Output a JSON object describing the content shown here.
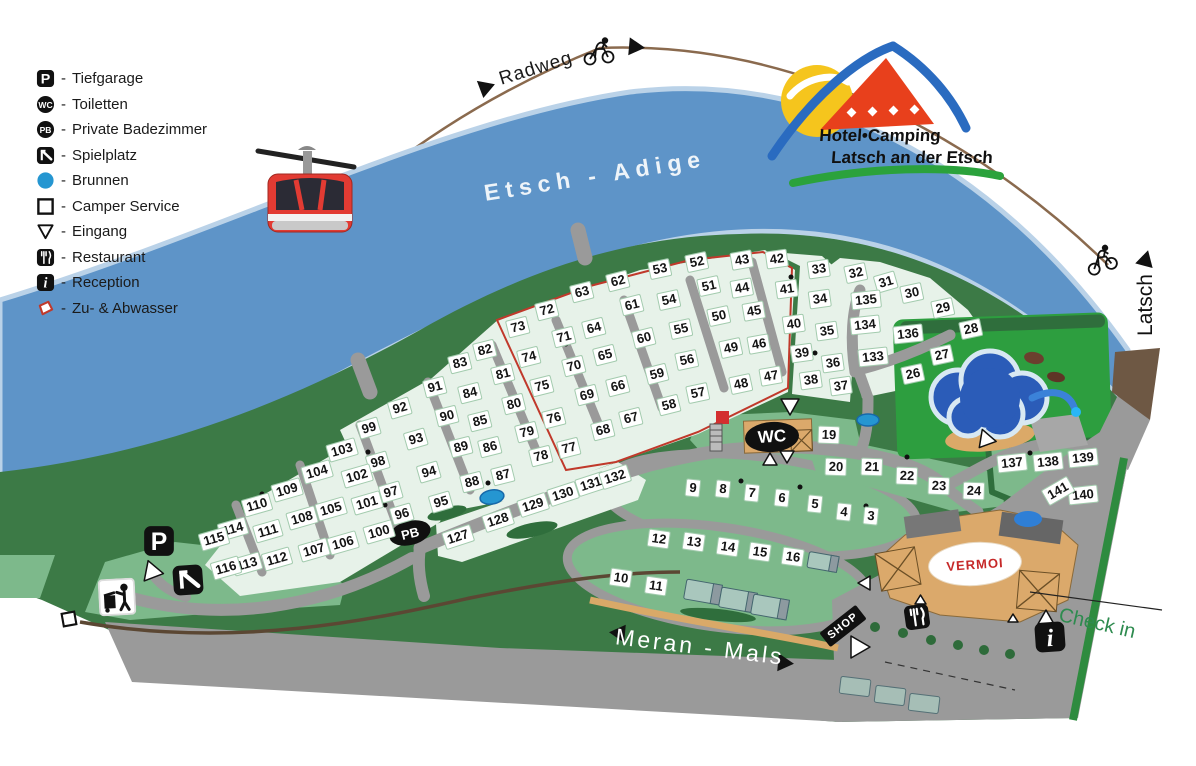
{
  "legend": {
    "sep": "-",
    "items": [
      {
        "icon": "tiefgarage",
        "label": "Tiefgarage"
      },
      {
        "icon": "toiletten",
        "label": "Toiletten"
      },
      {
        "icon": "private-badezimmer",
        "label": "Private Badezimmer"
      },
      {
        "icon": "spielplatz",
        "label": "Spielplatz"
      },
      {
        "icon": "brunnen",
        "label": "Brunnen"
      },
      {
        "icon": "camper-service",
        "label": "Camper Service"
      },
      {
        "icon": "eingang",
        "label": "Eingang"
      },
      {
        "icon": "restaurant",
        "label": "Restaurant"
      },
      {
        "icon": "reception",
        "label": "Reception"
      },
      {
        "icon": "zu-abwasser",
        "label": "Zu- & Abwasser"
      }
    ]
  },
  "logo": {
    "line1": "Hotel•Camping",
    "line2": "Latsch an der Etsch"
  },
  "labels": {
    "river": "Etsch - Adige",
    "bike_path": "Radweg",
    "road": "Meran - Mals",
    "town": "Latsch",
    "check_in": "Check in",
    "shop": "SHOP",
    "wc": "WC",
    "pb": "PB",
    "vermoi": "VERMOI"
  },
  "map": {
    "pitches": [
      [
        3,
        871,
        516,
        6
      ],
      [
        4,
        844,
        512,
        6
      ],
      [
        5,
        815,
        504,
        6
      ],
      [
        6,
        782,
        498,
        6
      ],
      [
        7,
        752,
        493,
        6
      ],
      [
        8,
        723,
        489,
        6
      ],
      [
        9,
        693,
        488,
        6
      ],
      [
        10,
        621,
        578,
        8
      ],
      [
        11,
        656,
        586,
        8
      ],
      [
        12,
        659,
        539,
        8
      ],
      [
        13,
        694,
        542,
        8
      ],
      [
        14,
        728,
        547,
        8
      ],
      [
        15,
        760,
        552,
        8
      ],
      [
        16,
        793,
        557,
        8
      ],
      [
        19,
        829,
        435,
        2
      ],
      [
        20,
        836,
        467,
        2
      ],
      [
        21,
        872,
        467,
        2
      ],
      [
        22,
        907,
        476,
        2
      ],
      [
        23,
        939,
        486,
        2
      ],
      [
        24,
        974,
        491,
        2
      ],
      [
        26,
        913,
        374,
        -12
      ],
      [
        27,
        942,
        355,
        -12
      ],
      [
        28,
        971,
        329,
        -12
      ],
      [
        29,
        943,
        308,
        -12
      ],
      [
        30,
        912,
        293,
        -12
      ],
      [
        31,
        886,
        282,
        -16
      ],
      [
        32,
        856,
        273,
        -12
      ],
      [
        33,
        819,
        269,
        -8
      ],
      [
        34,
        820,
        299,
        -8
      ],
      [
        35,
        827,
        331,
        -8
      ],
      [
        36,
        833,
        363,
        -8
      ],
      [
        37,
        841,
        386,
        -8
      ],
      [
        38,
        811,
        380,
        -8
      ],
      [
        39,
        802,
        353,
        -8
      ],
      [
        40,
        794,
        324,
        -8
      ],
      [
        41,
        787,
        289,
        -8
      ],
      [
        42,
        777,
        259,
        -8
      ],
      [
        43,
        742,
        260,
        -10
      ],
      [
        44,
        742,
        288,
        -10
      ],
      [
        45,
        754,
        311,
        -10
      ],
      [
        46,
        759,
        344,
        -10
      ],
      [
        47,
        771,
        376,
        -10
      ],
      [
        48,
        741,
        384,
        -12
      ],
      [
        49,
        731,
        348,
        -12
      ],
      [
        50,
        719,
        316,
        -12
      ],
      [
        51,
        709,
        286,
        -12
      ],
      [
        52,
        697,
        262,
        -12
      ],
      [
        53,
        660,
        269,
        -12
      ],
      [
        54,
        669,
        300,
        -12
      ],
      [
        55,
        681,
        329,
        -12
      ],
      [
        56,
        687,
        360,
        -12
      ],
      [
        57,
        698,
        393,
        -12
      ],
      [
        58,
        669,
        405,
        -14
      ],
      [
        59,
        657,
        374,
        -14
      ],
      [
        60,
        644,
        338,
        -14
      ],
      [
        61,
        632,
        305,
        -14
      ],
      [
        62,
        618,
        281,
        -14
      ],
      [
        63,
        582,
        292,
        -14
      ],
      [
        64,
        594,
        328,
        -14
      ],
      [
        65,
        605,
        355,
        -14
      ],
      [
        66,
        618,
        386,
        -14
      ],
      [
        67,
        631,
        418,
        -14
      ],
      [
        68,
        603,
        430,
        -14
      ],
      [
        69,
        587,
        395,
        -14
      ],
      [
        70,
        574,
        366,
        -14
      ],
      [
        71,
        564,
        337,
        -14
      ],
      [
        72,
        547,
        310,
        -14
      ],
      [
        73,
        518,
        327,
        -14
      ],
      [
        74,
        529,
        357,
        -14
      ],
      [
        75,
        542,
        386,
        -14
      ],
      [
        76,
        554,
        418,
        -14
      ],
      [
        77,
        569,
        448,
        -14
      ],
      [
        78,
        541,
        456,
        -14
      ],
      [
        79,
        527,
        432,
        -14
      ],
      [
        80,
        514,
        404,
        -14
      ],
      [
        81,
        503,
        374,
        -14
      ],
      [
        82,
        485,
        350,
        -14
      ],
      [
        83,
        460,
        363,
        -14
      ],
      [
        84,
        470,
        393,
        -14
      ],
      [
        85,
        480,
        421,
        -14
      ],
      [
        86,
        490,
        447,
        -14
      ],
      [
        87,
        503,
        475,
        -14
      ],
      [
        88,
        472,
        482,
        -14
      ],
      [
        89,
        461,
        447,
        -14
      ],
      [
        90,
        447,
        416,
        -14
      ],
      [
        91,
        435,
        387,
        -14
      ],
      [
        92,
        400,
        408,
        -16
      ],
      [
        93,
        416,
        439,
        -16
      ],
      [
        94,
        429,
        472,
        -16
      ],
      [
        95,
        441,
        502,
        -16
      ],
      [
        96,
        402,
        514,
        -16
      ],
      [
        97,
        391,
        492,
        -16
      ],
      [
        98,
        378,
        462,
        -16
      ],
      [
        99,
        369,
        428,
        -16
      ],
      [
        100,
        379,
        532,
        -16
      ],
      [
        101,
        367,
        503,
        -16
      ],
      [
        102,
        357,
        476,
        -16
      ],
      [
        103,
        342,
        450,
        -16
      ],
      [
        104,
        317,
        472,
        -16
      ],
      [
        105,
        331,
        509,
        -16
      ],
      [
        106,
        343,
        543,
        -16
      ],
      [
        107,
        314,
        550,
        -16
      ],
      [
        108,
        302,
        518,
        -16
      ],
      [
        109,
        287,
        490,
        -16
      ],
      [
        110,
        257,
        505,
        -16
      ],
      [
        111,
        268,
        531,
        -16
      ],
      [
        112,
        277,
        559,
        -16
      ],
      [
        113,
        247,
        564,
        -16
      ],
      [
        114,
        233,
        529,
        -16
      ],
      [
        115,
        214,
        539,
        -16
      ],
      [
        116,
        226,
        568,
        -16
      ],
      [
        127,
        458,
        537,
        -18
      ],
      [
        128,
        498,
        520,
        -18
      ],
      [
        129,
        533,
        505,
        -18
      ],
      [
        130,
        563,
        494,
        -18
      ],
      [
        131,
        591,
        484,
        -18
      ],
      [
        132,
        615,
        477,
        -18
      ],
      [
        133,
        873,
        357,
        -6
      ],
      [
        134,
        865,
        325,
        -6
      ],
      [
        135,
        866,
        300,
        -6
      ],
      [
        136,
        908,
        334,
        -6
      ],
      [
        137,
        1012,
        463,
        -6
      ],
      [
        138,
        1048,
        462,
        -6
      ],
      [
        139,
        1083,
        458,
        -6
      ],
      [
        140,
        1083,
        495,
        -6
      ],
      [
        141,
        1058,
        491,
        -30
      ]
    ]
  }
}
